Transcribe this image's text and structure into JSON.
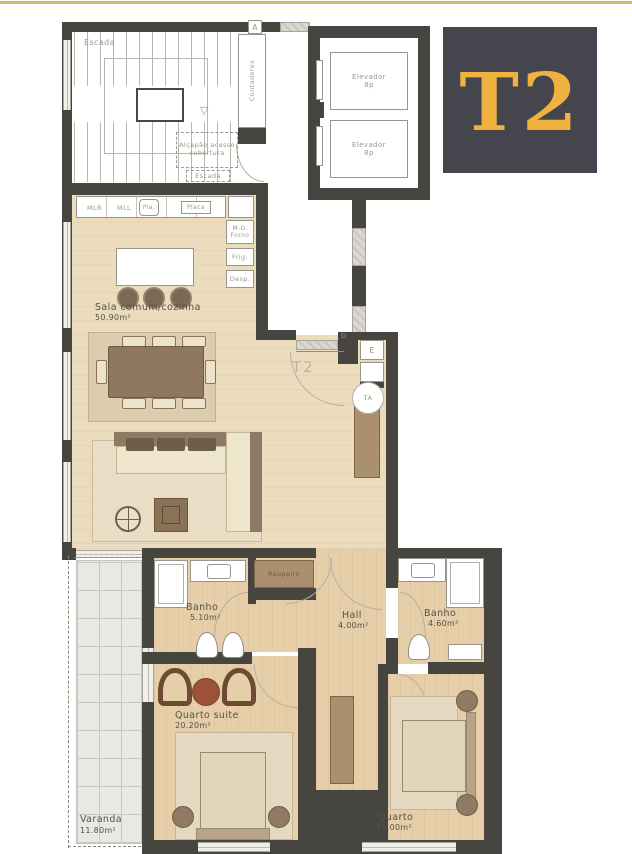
{
  "logo": {
    "text": "T2",
    "bg": "#44454D",
    "color": "#F0B23E"
  },
  "page": {
    "top_line_color": "#D3BA66",
    "wall_color": "#474540",
    "wood_color": "#ECDCBE"
  },
  "markers": {
    "a": "A",
    "d": "D",
    "e": "E",
    "ta": "TA",
    "unit": "T2"
  },
  "common_areas": {
    "escada": "Escada",
    "contadores": "Contadores",
    "alcapao": "Alçapão acesso cobertura",
    "alcapao_escada": "Escada",
    "elev1_name": "Elevador",
    "elev1_cap": "8p",
    "elev2_name": "Elevador",
    "elev2_cap": "8p"
  },
  "kitchen": {
    "mlr": "MLR",
    "mll": "MLL",
    "pia": "Pia.",
    "placa": "Placa",
    "mo_forno": "M.O. Forno",
    "frig": "Frig.",
    "desp": "Desp."
  },
  "rooms": {
    "sala": {
      "name": "Sala comum/cozinha",
      "area": "50.90m²"
    },
    "banho1": {
      "name": "Banho",
      "area": "5.10m²"
    },
    "hall": {
      "name": "Hall",
      "area": "4.00m²"
    },
    "banho2": {
      "name": "Banho",
      "area": "4.60m²"
    },
    "suite": {
      "name": "Quarto suite",
      "area": "20.20m²"
    },
    "quarto": {
      "name": "Quarto",
      "area": "15.00m²"
    },
    "varanda": {
      "name": "Varanda",
      "area": "11.80m²"
    }
  },
  "furniture": {
    "roupeiro": "Roupeiro"
  }
}
